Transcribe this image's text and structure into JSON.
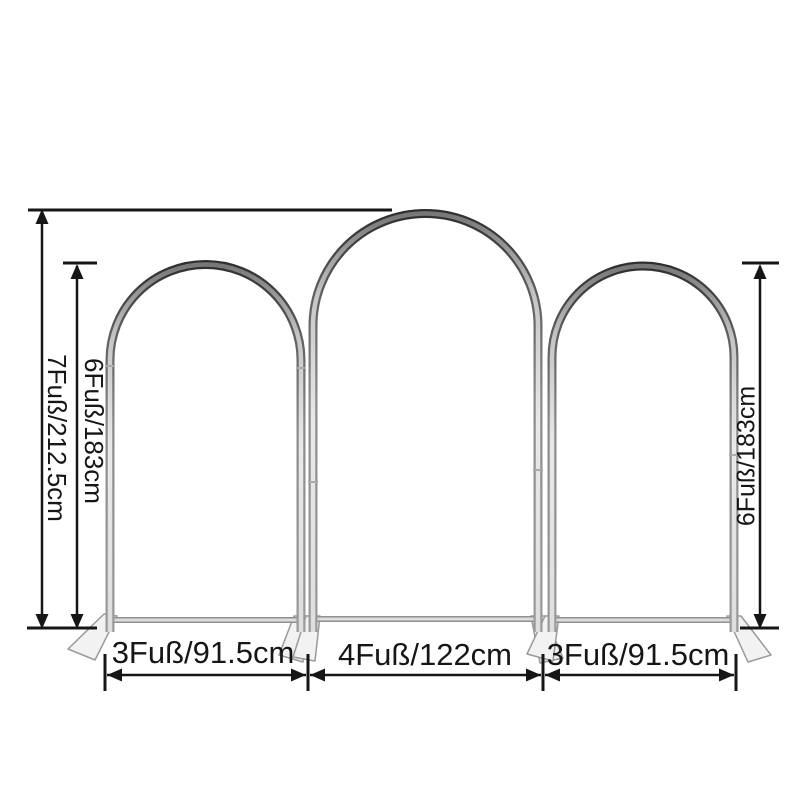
{
  "image": {
    "subject": "three-arch-backdrop-stand-set-with-dimensions",
    "colors": {
      "background": "#ffffff",
      "dimension_lines": "#161616",
      "frame_dark": "#3a3a3a",
      "frame_silver": "#c9c9c9",
      "feet_fill": "#f2f2f2"
    }
  },
  "arches": {
    "left": {
      "height": "6Fuß/183cm",
      "width": "3Fuß/91.5cm"
    },
    "middle": {
      "height": "7Fuß/212.5cm",
      "width": "4Fuß/122cm"
    },
    "right": {
      "height": "6Fuß/183cm",
      "width": "3Fuß/91.5cm"
    }
  }
}
